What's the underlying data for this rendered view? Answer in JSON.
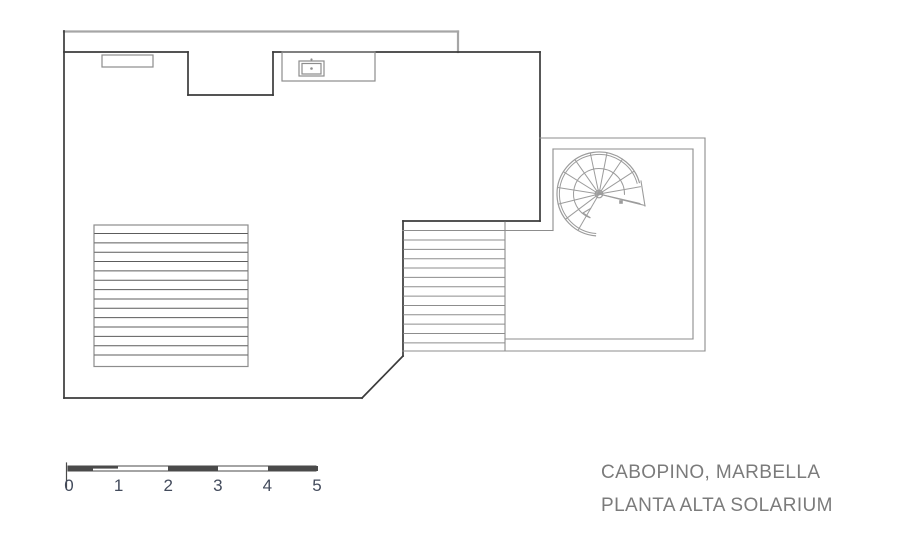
{
  "titleblock": {
    "line1": "CABOPINO, MARBELLA",
    "line2": "PLANTA ALTA SOLARIUM"
  },
  "scalebar": {
    "labels": [
      "0",
      "1",
      "2",
      "3",
      "4",
      "5"
    ],
    "x": 68,
    "y": 466,
    "h": 5,
    "meter_px": 49.6,
    "dark_fills": [
      [
        68,
        466,
        25,
        5
      ],
      [
        93,
        466,
        25,
        2.6
      ],
      [
        168,
        466,
        50,
        5
      ],
      [
        268,
        466,
        50,
        5
      ]
    ],
    "tick": [
      66.5,
      463,
      66.5,
      489
    ],
    "label_y": 491,
    "label_font_px": 17
  },
  "colors": {
    "background": "#ffffff",
    "outline": "#3b3b3b",
    "strip_top": "#a6a6a6",
    "gray": "#8d8d8d",
    "hatch": "#5c5c5c",
    "spiral": "#9c9c9c",
    "scalebar_dark": "#4a4a4a",
    "scale_text": "#434b5c",
    "title_text": "#7b7b7b"
  },
  "plan": {
    "stroke_dark": 1.7,
    "stroke_gray": 1.1,
    "segments_top_gray": [
      [
        64,
        31.5,
        458,
        31.5
      ],
      [
        458,
        31.5,
        458,
        52
      ]
    ],
    "segments_dark": [
      [
        64,
        52,
        188,
        52
      ],
      [
        188,
        52,
        188,
        95
      ],
      [
        188,
        95,
        273,
        95
      ],
      [
        273,
        95,
        273,
        52
      ],
      [
        273,
        52,
        540,
        52
      ],
      [
        64,
        31,
        64,
        398
      ],
      [
        64,
        398,
        362,
        398
      ],
      [
        362,
        398,
        403,
        356
      ],
      [
        403,
        356,
        403,
        221
      ],
      [
        403,
        221,
        540,
        221
      ],
      [
        540,
        221,
        540,
        52
      ]
    ],
    "segments_gray": [
      [
        540,
        138,
        705,
        138
      ],
      [
        705,
        138,
        705,
        351
      ],
      [
        705,
        351,
        403,
        351
      ],
      [
        553,
        149,
        693,
        149
      ],
      [
        693,
        149,
        693,
        339
      ],
      [
        693,
        339,
        505,
        339
      ],
      [
        553,
        149,
        553,
        230.5
      ],
      [
        403,
        230.5,
        553,
        230.5
      ],
      [
        505,
        222,
        505,
        351
      ]
    ],
    "rects": [
      {
        "x": 102,
        "y": 55,
        "w": 51,
        "h": 12,
        "layer": "fixtures"
      },
      {
        "x": 282,
        "y": 52,
        "w": 93,
        "h": 29,
        "layer": "fixtures"
      },
      {
        "x": 299,
        "y": 61,
        "w": 25,
        "h": 15,
        "layer": "fixtures"
      },
      {
        "x": 302,
        "y": 63.5,
        "w": 19,
        "h": 10.5,
        "layer": "fixtures"
      },
      {
        "x": 94,
        "y": 225,
        "w": 154,
        "h": 141.5,
        "layer": "pergola"
      }
    ],
    "dots": [
      {
        "x": 311.5,
        "y": 59.5,
        "r": 1.1
      },
      {
        "x": 311.5,
        "y": 68.5,
        "r": 1.3
      }
    ],
    "hatches": [
      {
        "x1": 94.8,
        "x2": 247.3,
        "y0": 233.5,
        "dy": 9.35,
        "n": 14,
        "layer": "pergola"
      },
      {
        "x1": 403.8,
        "x2": 505,
        "y0": 240,
        "dy": 9.35,
        "n": 12,
        "layer": "stairs"
      }
    ],
    "spiral": {
      "cx": 599,
      "cy": 194,
      "r_outer": 42,
      "r_outer2": 39.6,
      "r_inner": 25.5,
      "outer_arc": [
        15,
        266
      ],
      "inner_arc": [
        -2,
        250
      ],
      "radials": [
        -13,
        10,
        33,
        56,
        79,
        102,
        125,
        148,
        171,
        194,
        217,
        240
      ],
      "rail": [
        599,
        194,
        645,
        205.5
      ],
      "chord": [
        641,
        181,
        645,
        206
      ],
      "pole_r": 3.8,
      "hub_r": 1.4,
      "square": {
        "x": 621,
        "y": 202,
        "s": 3.6
      },
      "arrow": [
        [
          583,
          213,
          590.5,
          208.5
        ],
        [
          583,
          213,
          590,
          217.5
        ]
      ]
    }
  }
}
